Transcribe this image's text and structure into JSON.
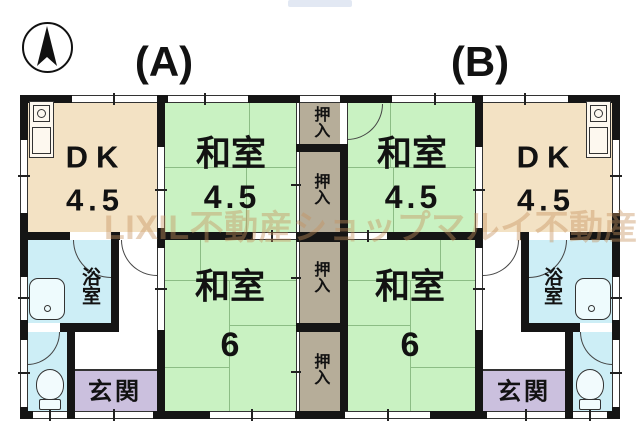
{
  "watermark": "LIXIL不動産ショップマルイ不動産",
  "unit_labels": {
    "a": "(A)",
    "b": "(B)"
  },
  "rooms": {
    "dk": {
      "name": "DK",
      "size": "4.5"
    },
    "washitsu_45": {
      "name": "和室",
      "size": "4.5"
    },
    "washitsu_6": {
      "name": "和室",
      "size": "6"
    },
    "oshiire": {
      "name": "押入"
    },
    "bathroom": {
      "name": "浴室"
    },
    "genkan": {
      "name": "玄関"
    }
  },
  "icons": {
    "compass": "north-compass",
    "kitchen": "kitchen-sink-stove",
    "bathtub": "bathtub",
    "toilet": "toilet"
  },
  "colors": {
    "wall": "#151515",
    "dk_floor": "#f3e2c4",
    "washitsu_floor": "#c9f2c2",
    "closet": "#b6ad99",
    "wet_room": "#cdeef6",
    "genkan_floor": "#cbc0de",
    "tatami_line": "#8cbd85",
    "watermark_text": "rgba(198,146,94,0.42)"
  }
}
